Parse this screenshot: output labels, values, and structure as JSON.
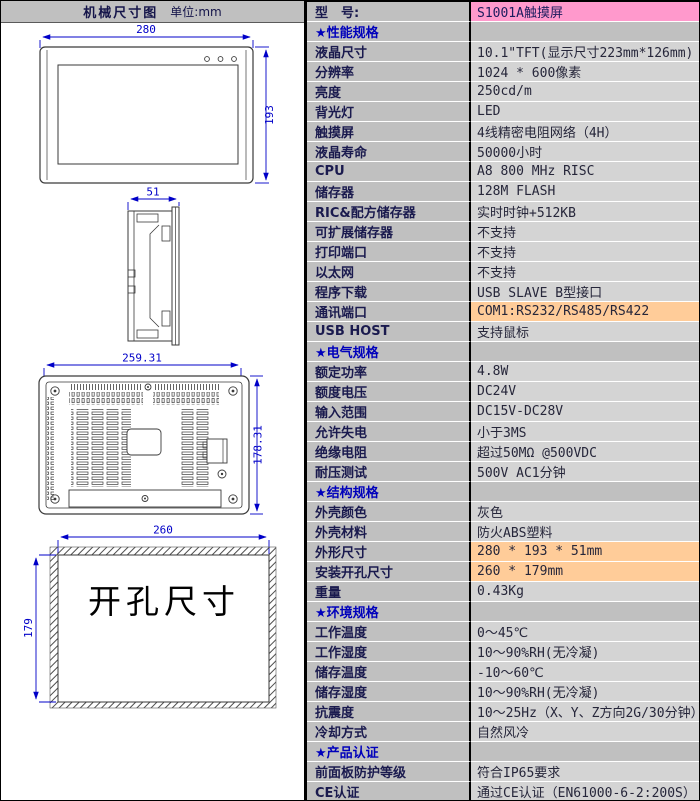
{
  "left_panel": {
    "header": {
      "title": "机械尺寸图",
      "unit": "单位:mm"
    },
    "front_view": {
      "width_dim": "280",
      "height_dim": "193",
      "led_count": 3
    },
    "side_view": {
      "depth_dim": "51"
    },
    "rear_view": {
      "width_dim": "259.31",
      "height_dim": "178.31"
    },
    "cutout_view": {
      "width_dim": "260",
      "height_dim": "179",
      "caption": "开孔尺寸"
    }
  },
  "spec_table": {
    "rows": [
      {
        "type": "model",
        "label": "型　号:",
        "value": "S1001A触摸屏"
      },
      {
        "type": "section",
        "label": "★性能规格",
        "value": ""
      },
      {
        "type": "item",
        "label": "液晶尺寸",
        "value": "10.1\"TFT(显示尺寸223mm*126mm)"
      },
      {
        "type": "item",
        "label": "分辨率",
        "value": "1024 * 600像素"
      },
      {
        "type": "item",
        "label": "亮度",
        "value": "250cd/m"
      },
      {
        "type": "item",
        "label": "背光灯",
        "value": "LED"
      },
      {
        "type": "item",
        "label": "触摸屏",
        "value": "4线精密电阻网络（4H）"
      },
      {
        "type": "item",
        "label": "液晶寿命",
        "value": "50000小时"
      },
      {
        "type": "item",
        "label": "CPU",
        "value": "A8 800 MHz RISC"
      },
      {
        "type": "item",
        "label": "储存器",
        "value": "128M FLASH"
      },
      {
        "type": "item",
        "label": "RIC&配方储存器",
        "value": "实时时钟+512KB"
      },
      {
        "type": "item",
        "label": "可扩展储存器",
        "value": "不支持"
      },
      {
        "type": "item",
        "label": "打印端口",
        "value": "不支持"
      },
      {
        "type": "item",
        "label": "以太网",
        "value": "不支持"
      },
      {
        "type": "item",
        "label": "程序下载",
        "value": "USB SLAVE B型接口"
      },
      {
        "type": "item",
        "label": "通讯端口",
        "value": "COM1:RS232/RS485/RS422",
        "highlight": true
      },
      {
        "type": "item",
        "label": "USB HOST",
        "value": "支持鼠标"
      },
      {
        "type": "section",
        "label": "★电气规格",
        "value": ""
      },
      {
        "type": "item",
        "label": "额定功率",
        "value": "4.8W"
      },
      {
        "type": "item",
        "label": "额度电压",
        "value": "DC24V"
      },
      {
        "type": "item",
        "label": "输入范围",
        "value": "DC15V-DC28V"
      },
      {
        "type": "item",
        "label": "允许失电",
        "value": "小于3MS"
      },
      {
        "type": "item",
        "label": "绝缘电阻",
        "value": "超过50MΩ @500VDC"
      },
      {
        "type": "item",
        "label": "耐压测试",
        "value": "500V AC1分钟"
      },
      {
        "type": "section",
        "label": "★结构规格",
        "value": ""
      },
      {
        "type": "item",
        "label": "外壳颜色",
        "value": "灰色"
      },
      {
        "type": "item",
        "label": "外壳材料",
        "value": "防火ABS塑料"
      },
      {
        "type": "item",
        "label": "外形尺寸",
        "value": "280 * 193 * 51mm",
        "highlight": true
      },
      {
        "type": "item",
        "label": "安装开孔尺寸",
        "value": "260 * 179mm",
        "highlight": true
      },
      {
        "type": "item",
        "label": "重量",
        "value": "0.43Kg"
      },
      {
        "type": "section",
        "label": "★环境规格",
        "value": ""
      },
      {
        "type": "item",
        "label": "工作温度",
        "value": "0～45℃"
      },
      {
        "type": "item",
        "label": "工作湿度",
        "value": "10～90%RH(无冷凝)"
      },
      {
        "type": "item",
        "label": "储存温度",
        "value": "-10～60℃"
      },
      {
        "type": "item",
        "label": "储存湿度",
        "value": "10～90%RH(无冷凝)"
      },
      {
        "type": "item",
        "label": "抗震度",
        "value": "10～25Hz（X、Y、Z方向2G/30分钟）"
      },
      {
        "type": "item",
        "label": "冷却方式",
        "value": "自然风冷"
      },
      {
        "type": "section",
        "label": "★产品认证",
        "value": ""
      },
      {
        "type": "item",
        "label": "前面板防护等级",
        "value": "符合IP65要求"
      },
      {
        "type": "item",
        "label": "CE认证",
        "value": "通过CE认证（EN61000-6-2:200S）"
      }
    ]
  },
  "colors": {
    "panel_header_bg": "#C0C0C0",
    "label_bg": "#C0C0C0",
    "value_bg": "#D4D4D4",
    "model_value_bg": "#FF99CC",
    "highlight_bg": "#FFCC99",
    "section_text": "#0000BB",
    "label_text": "#1A1A4E",
    "dimension_color": "#0000C8"
  }
}
